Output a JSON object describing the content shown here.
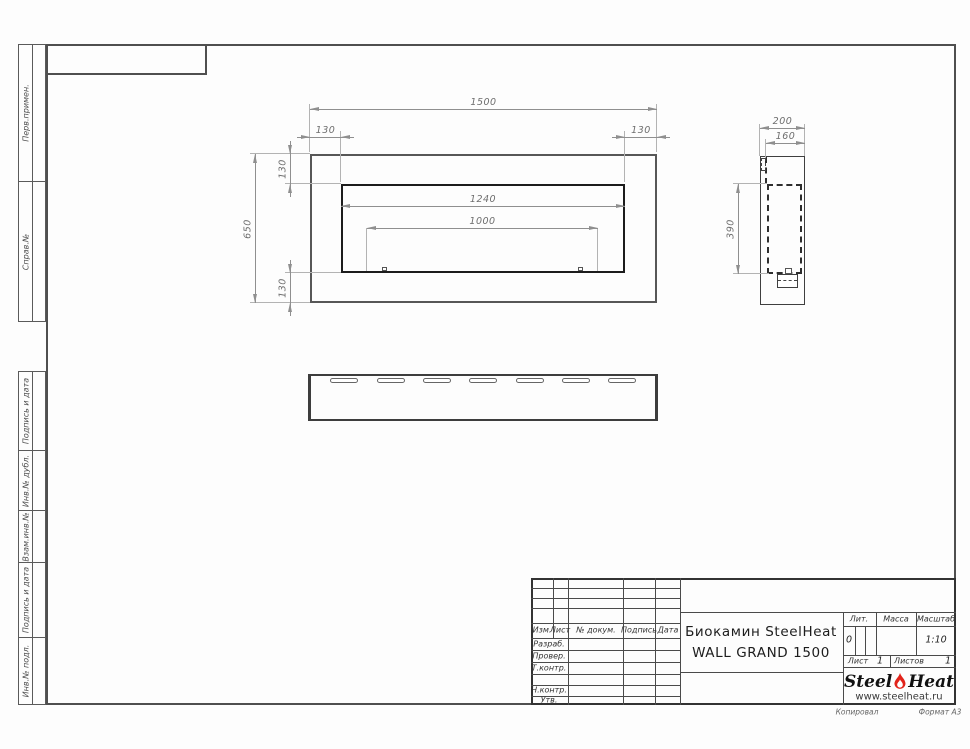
{
  "margin": {
    "labels": [
      "Перв.примен.",
      "Справ.№",
      "Подпись и дата",
      "Инв.№ дубл.",
      "Взам.инв.№",
      "Подпись и дата",
      "Инв.№ подл."
    ]
  },
  "dims": {
    "front_width": "1500",
    "front_height": "650",
    "front_top_left_offset": "130",
    "front_top_right_offset": "130",
    "front_left_top_offset": "130",
    "front_left_bottom_offset": "130",
    "front_opening_width": "1240",
    "front_burner_width": "1000",
    "side_depth": "200",
    "side_inner_depth": "160",
    "side_inner_height": "390"
  },
  "title_block": {
    "header": [
      "Изм.",
      "Лист",
      "№ докум.",
      "Подпись",
      "Дата"
    ],
    "role_rows": [
      "Разраб.",
      "Провер.",
      "Т.контр.",
      "Н.контр.",
      "Утв."
    ],
    "title_line1": "Биокамин SteelHeat",
    "title_line2": "WALL GRAND 1500",
    "lit_label": "Лит.",
    "lit_value": "0",
    "mass_label": "Масса",
    "scale_label": "Масштаб",
    "scale_value": "1:10",
    "sheet_label": "Лист",
    "sheet_number": "1",
    "sheets_label": "Листов",
    "sheets_total": "1",
    "logo_steel": "Steel",
    "logo_heat": "Heat",
    "logo_url": "www.steelheat.ru",
    "copied_label": "Копировал",
    "format_label": "Формат А3",
    "accent_color": "#e2231a"
  }
}
